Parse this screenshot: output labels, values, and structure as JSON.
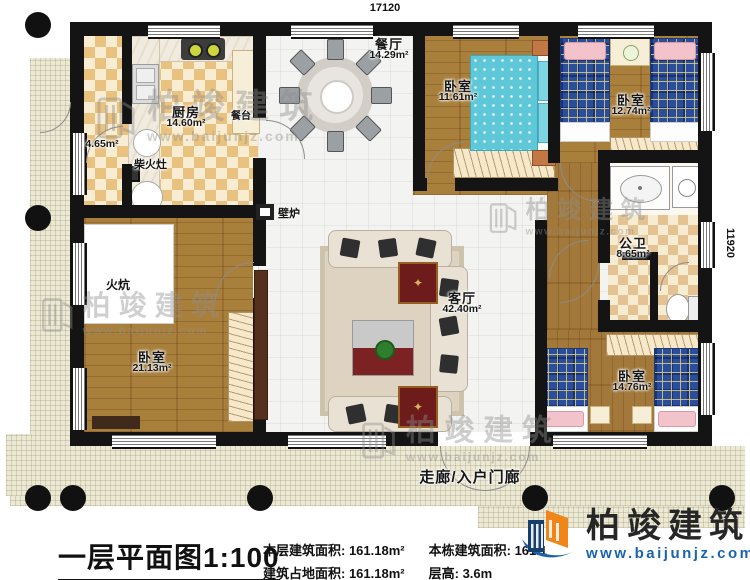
{
  "dims": {
    "width": "17120",
    "height": "11920"
  },
  "rooms": {
    "dining": {
      "name": "餐厅",
      "area": "14.29m²"
    },
    "kitchen": {
      "name": "厨房",
      "area": "14.60m²"
    },
    "storage": {
      "area": "4.65m²"
    },
    "bedroom1": {
      "name": "卧室",
      "area": "11.61m²"
    },
    "bedroom2": {
      "name": "卧室",
      "area": "12.74m²"
    },
    "bathroom": {
      "name": "公卫",
      "area": "8.65m²"
    },
    "bedroom3": {
      "name": "卧室",
      "area": "21.13m²"
    },
    "living": {
      "name": "客厅",
      "area": "42.40m²"
    },
    "bedroom4": {
      "name": "卧室",
      "area": "14.76m²"
    }
  },
  "features": {
    "firewood_stove": "柴火灶",
    "serving_counter": "餐台",
    "fireplace": "壁炉",
    "kang": "火炕",
    "corridor": "走廊/入户门廊"
  },
  "infobar": {
    "title": "一层平面图1:100",
    "floor_area_label": "本层建筑面积: ",
    "floor_area_value": "161.18m²",
    "building_area_label": "本栋建筑面积: ",
    "building_area_value": "161.1",
    "footprint_label": "建筑占地面积: ",
    "footprint_value": "161.18m²",
    "storey_height_label": "层高: ",
    "storey_height_value": "3.6m"
  },
  "branding": {
    "company": "柏竣建筑",
    "website": "www.baijunjz.com"
  }
}
